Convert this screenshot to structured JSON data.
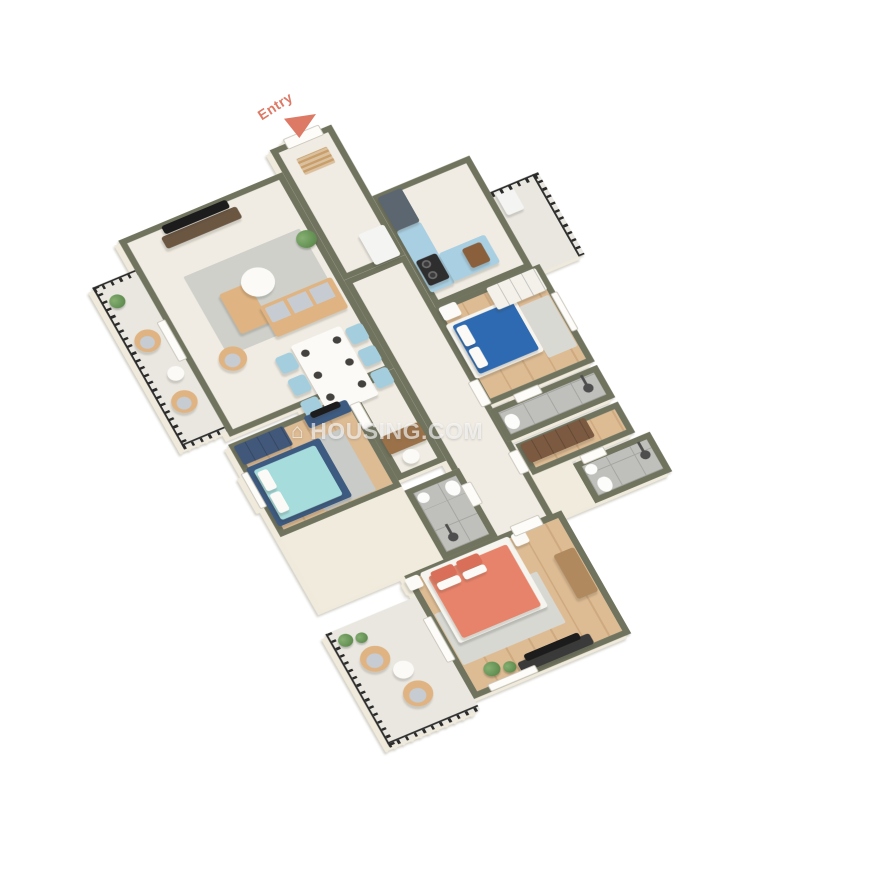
{
  "labels": {
    "entry": "Entry"
  },
  "watermark": {
    "text": "HOUSING.COM",
    "icon": "house-icon"
  },
  "palette": {
    "background": "#ffffff",
    "wallTop": "#70735e",
    "wallFace": "#f0ebdd",
    "marble": "#f0ece3",
    "wood": "#ddbb93",
    "woodDark": "#cfa97f",
    "tile": "#bfbfbb",
    "tileLine": "#a5a5a1",
    "balconyFloor": "#e9e7e0",
    "railing": "#2b2b2b",
    "rug": "#cfd0ca",
    "sofaTan": "#dfb382",
    "cushionGray": "#c6ccd2",
    "chairBlue": "#a4cede",
    "tableWhite": "#fbfaf7",
    "kitchenCab": "#a9cfe2",
    "kitchenCabDark": "#5b6670",
    "bedBlue": "#2e6ab1",
    "bedTeal": "#a6dcdb",
    "bedCoral": "#e8836b",
    "pillowCoral": "#d96f58",
    "bedFrameDark": "#3d5a80",
    "wardrobeBlue": "#41587a",
    "wardrobeWhite": "#f3f1ea",
    "wardrobeBrown": "#7b5a41",
    "woodFurn": "#b08a5e",
    "tv": "#1c1c1c",
    "fridge": "#f4f4f2",
    "toiletWhite": "#fcfcfa",
    "plantGreen": "#517e43",
    "accentEntry": "#dd7a66",
    "doorWhite": "#fdfcf9",
    "doorEdge": "#c9c5ba"
  },
  "rooms": [
    {
      "name": "entry-foyer",
      "floor": "marble",
      "items": [
        "entry-door",
        "doormat",
        "refrigerator"
      ]
    },
    {
      "name": "living-dining",
      "floor": "marble",
      "items": [
        "wall-tv",
        "tv-console",
        "l-sofa",
        "tub-armchair",
        "coffee-table",
        "rug",
        "plant",
        "dining-table",
        "six-blue-chairs",
        "place-settings"
      ]
    },
    {
      "name": "kitchen",
      "floor": "marble",
      "items": [
        "upper-cabinet",
        "base-cabinet",
        "counter",
        "stove",
        "pots",
        "cutting-board"
      ]
    },
    {
      "name": "utility-balcony",
      "floor": "concrete",
      "items": [
        "railing",
        "cabinet"
      ]
    },
    {
      "name": "west-balcony",
      "floor": "concrete",
      "items": [
        "railing",
        "two-tub-chairs",
        "side-table",
        "plant"
      ]
    },
    {
      "name": "bedroom-blue",
      "floor": "wood",
      "items": [
        "double-bed-blue",
        "bedside-table",
        "wardrobe",
        "rug",
        "window"
      ]
    },
    {
      "name": "bedroom-teal",
      "floor": "wood",
      "items": [
        "double-bed-teal",
        "wardrobe-blue",
        "tv-console",
        "rug",
        "window"
      ]
    },
    {
      "name": "master-bedroom",
      "floor": "wood",
      "items": [
        "double-bed-coral",
        "side-tables",
        "rug",
        "wood-console",
        "tv-console",
        "plants",
        "windows"
      ]
    },
    {
      "name": "master-balcony",
      "floor": "concrete",
      "items": [
        "railing",
        "two-tub-chairs",
        "round-table",
        "plants"
      ]
    },
    {
      "name": "corridor",
      "floor": "marble",
      "items": []
    },
    {
      "name": "passage",
      "floor": "marble",
      "items": [
        "desk",
        "chair"
      ]
    },
    {
      "name": "dressing",
      "floor": "wood",
      "items": [
        "wardrobe-brown"
      ]
    },
    {
      "name": "bathroom-ensuite-1",
      "floor": "tile",
      "items": [
        "shower",
        "toilet"
      ]
    },
    {
      "name": "bathroom-common",
      "floor": "tile",
      "items": [
        "shower",
        "toilet",
        "sink"
      ]
    },
    {
      "name": "bathroom-master",
      "floor": "tile",
      "items": [
        "shower",
        "toilet",
        "sink"
      ]
    }
  ]
}
